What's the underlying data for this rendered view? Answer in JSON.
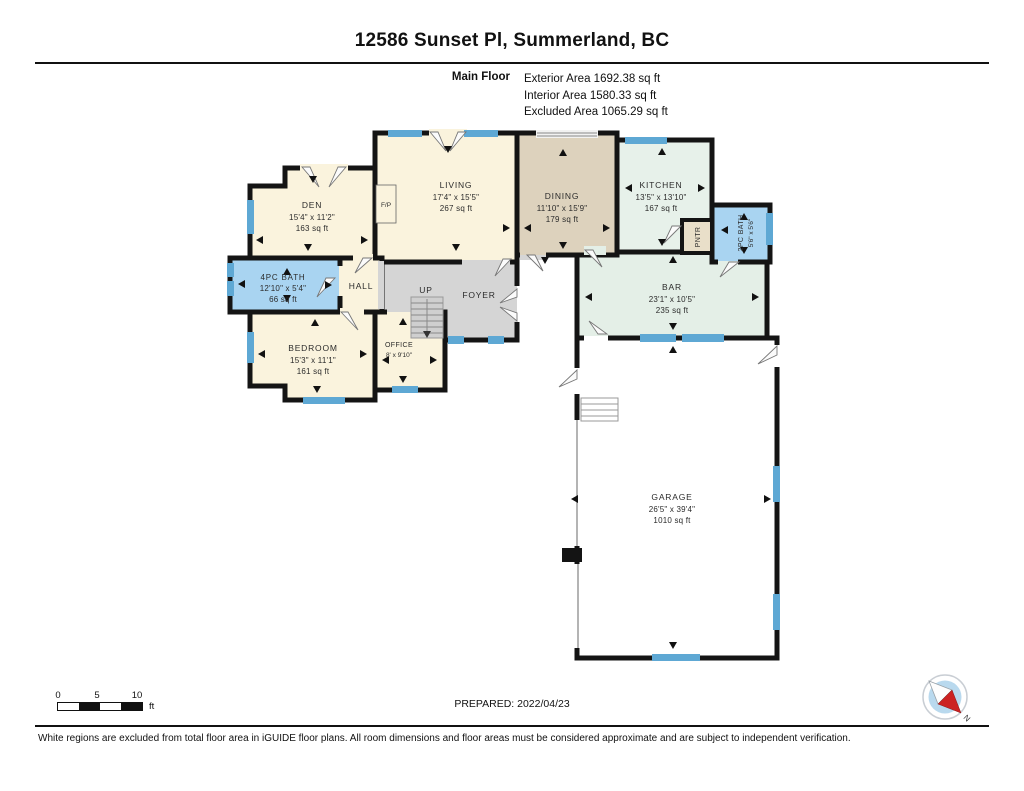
{
  "header": {
    "title": "12586 Sunset Pl, Summerland, BC",
    "floor_label": "Main Floor",
    "areas": [
      "Exterior Area 1692.38 sq ft",
      "Interior Area 1580.33 sq ft",
      "Excluded Area 1065.29 sq ft"
    ]
  },
  "rooms": {
    "den": {
      "name": "DEN",
      "dims": "15'4\" x 11'2\"",
      "area": "163 sq ft"
    },
    "living": {
      "name": "LIVING",
      "dims": "17'4\" x 15'5\"",
      "area": "267 sq ft"
    },
    "dining": {
      "name": "DINING",
      "dims": "11'10\" x 15'9\"",
      "area": "179 sq ft"
    },
    "kitchen": {
      "name": "KITCHEN",
      "dims": "13'5\" x 13'10\"",
      "area": "167 sq ft"
    },
    "bath2pc": {
      "name": "2PC BATH",
      "dims": "5'6\" x 5'6\""
    },
    "pantry": {
      "name": "PNTR"
    },
    "bath4pc": {
      "name": "4PC BATH",
      "dims": "12'10\" x 5'4\"",
      "area": "66 sq ft"
    },
    "hall": {
      "name": "HALL"
    },
    "stairs": {
      "name": "UP"
    },
    "foyer": {
      "name": "FOYER"
    },
    "bedroom": {
      "name": "BEDROOM",
      "dims": "15'3\" x 11'1\"",
      "area": "161 sq ft"
    },
    "office": {
      "name": "OFFICE",
      "dims": "8' x 9'10\""
    },
    "bar": {
      "name": "BAR",
      "dims": "23'1\" x 10'5\"",
      "area": "235 sq ft"
    },
    "garage": {
      "name": "GARAGE",
      "dims": "26'5\" x 39'4\"",
      "area": "1010 sq ft"
    },
    "fireplace": {
      "name": "F/P"
    }
  },
  "footer": {
    "scale": {
      "labels": [
        "0",
        "5",
        "10"
      ],
      "unit": "ft"
    },
    "prepared": "PREPARED: 2022/04/23",
    "compass_north": "N",
    "disclaimer": "White regions are excluded from total floor area in iGUIDE floor plans. All room dimensions and floor areas must be considered approximate and are subject to independent verification."
  },
  "colors": {
    "wall": "#141414",
    "room_cream": "#faf3dd",
    "room_tan": "#ddd2bd",
    "room_green": "#e7f1ea",
    "room_green2": "#e4efe7",
    "room_blue": "#a9d4f1",
    "room_gray": "#d5d5d5",
    "window_blue": "#5ea8d4",
    "compass_red": "#cc2222"
  }
}
